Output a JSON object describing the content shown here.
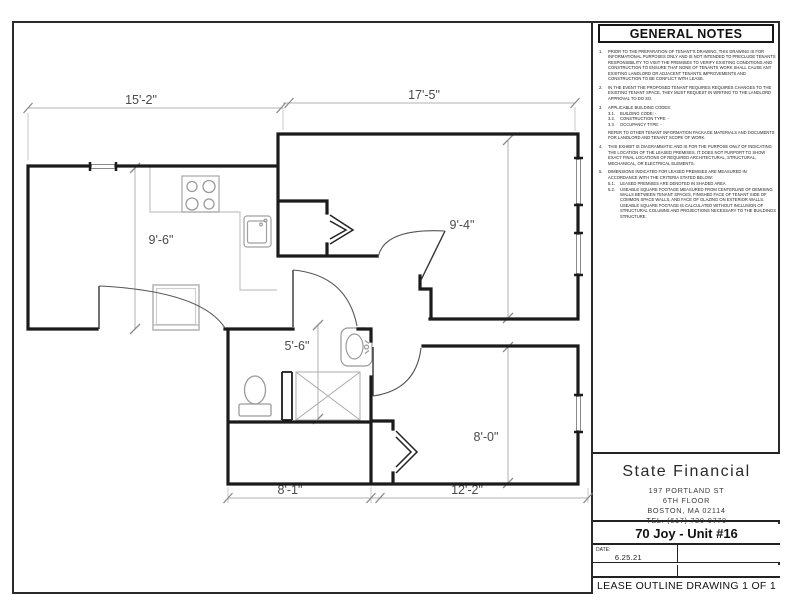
{
  "notes_panel": {
    "title": "GENERAL NOTES",
    "notes": [
      {
        "num": "1.",
        "text": "PRIOR TO THE PREPARATION OF TENANT'S DRAWING, THIS DRAWING IS FOR INFORMATIONAL PURPOSES ONLY AND IS NOT INTENDED TO PRECLUDE TENANTS RESPONSIBILITY TO VISIT THE PREMISES TO VERIFY EXISTING CONDITIONS AND CONSTRUCTION TO ENSURE THAT NONE OF TENANTS WORK SHALL CAUSE ANY EXISTING LANDLORD OR ADJACENT TENANTS IMPROVEMENTS AND CONSTRUCTION TO BE CONFLICT WITH LEASE."
      },
      {
        "num": "2.",
        "text": "IN THE EVENT THE PROPOSED TENANT REQUIRES REQUIRES CHANGES TO THE EXISTING TENANT SPACE, THEY MUST REQUEST  IN WRITING TO THE LANDLORD APPROVAL TO DO SO."
      },
      {
        "num": "3.",
        "text": "APPLICABLE BUILDING CODES:",
        "subs": [
          {
            "num": "3.1.",
            "text": "BUILDING CODE:  -"
          },
          {
            "num": "3.2.",
            "text": "CONSTRUCTION TYPE:  -"
          },
          {
            "num": "3.3.",
            "text": "OCCUPANCY TYPE:  -"
          }
        ],
        "extra": "REFER TO OTHER TENANT INFORMATION PACKAGE MATERIALS AND DOCUMENTS FOR LANDLORD AND TENANT SCOPE OF WORK."
      },
      {
        "num": "4.",
        "text": "THIS EXHIBIT IS DIAGRAMMATIC AND IS FOR THE PURPOSE ONLY OF INDICATING THE LOCATION OF THE LEASED PREMISES.  IT DOES NOT PURPORT TO SHOW EXACT FINAL LOCATIONS OF REQUIRED ARCHITECTURAL, STRUCTURAL, MECHANICAL, OR ELECTRICAL ELEMENTS."
      },
      {
        "num": "5.",
        "text": "DIMENSIONS INDICATED FOR LEASED PREMISES ARE MEASURED IN ACCORDANCE WITH THE CRITERIA STATED BELOW:",
        "subs": [
          {
            "num": "5.1.",
            "text": "LEASED PREMISES ARE DENOTED IN SHADED AREA"
          },
          {
            "num": "5.2.",
            "text": "USEABLE SQUARE FOOTAGE MEASURED FROM CENTERLINE OF DEMISING WALLS BETWEEN TENANT SPACES, FINISHED FACE OF TENANT SIDE OF COMMON SPACE WALLS, AND FACE OF GLAZING ON EXTERIOR WALLS.  USEABLE SQUARE FOOTAGE IS CALCULATED WITHOUT INCLUSION OF STRUCTURAL COLUMNS AND PROJECTIONS NECESSARY TO THE BUILDINGS STRUCTURE."
          }
        ]
      }
    ]
  },
  "title_block": {
    "company": "State Financial",
    "address_line1": "197 PORTLAND ST",
    "address_line2": "6TH FLOOR",
    "address_line3": "BOSTON, MA 02114",
    "address_line4": "TEL. (617) 720-0770",
    "project": "70 Joy - Unit #16",
    "date_label": "DATE:",
    "date_value": "6.25.21",
    "footer": "LEASE OUTLINE DRAWING 1 OF 1"
  },
  "floor_plan": {
    "dimensions": {
      "top_left": "15'-2\"",
      "top_right": "17'-5\"",
      "living_room": "9'-6\"",
      "bedroom": "9'-4\"",
      "bathroom": "5'-6\"",
      "bedroom2": "8'-0\"",
      "bottom_left": "8'-1\"",
      "bottom_right": "12'-2\""
    },
    "fixture_icons": [
      "stove-icon",
      "kitchen-sink-icon",
      "refrigerator-icon",
      "toilet-icon",
      "shower-icon",
      "bathroom-sink-icon"
    ],
    "wall_color": "#1b1b1b",
    "dim_color": "#b0b0b0"
  }
}
